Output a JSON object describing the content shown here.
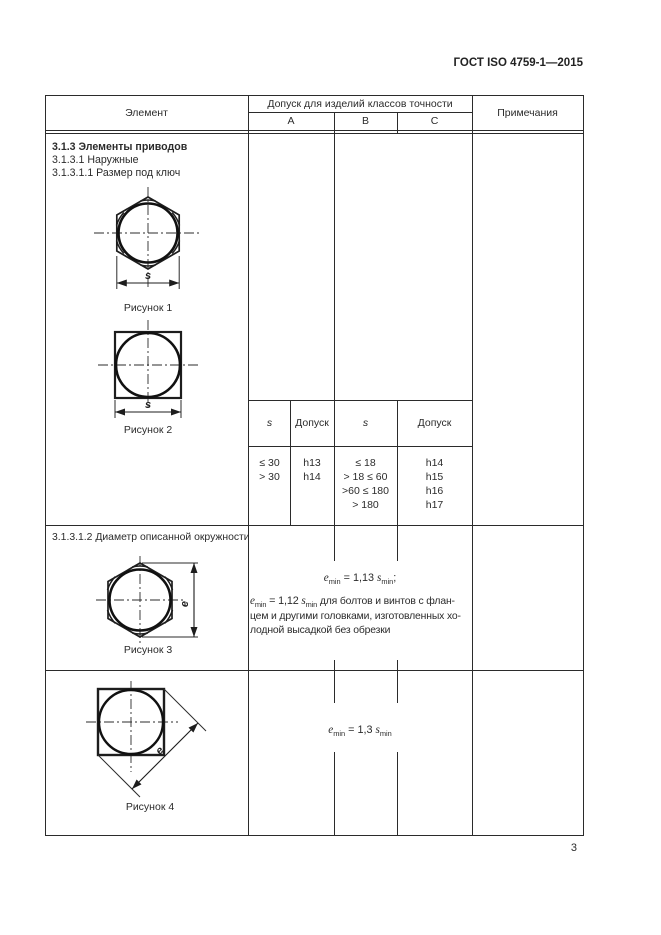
{
  "page": {
    "doc_header": "ГОСТ ISO 4759-1—2015",
    "page_number": "3"
  },
  "table": {
    "header": {
      "element": "Элемент",
      "tolerance_span": "Допуск для изделий классов точности",
      "class_a": "A",
      "class_b": "B",
      "class_c": "C",
      "notes": "Примечания"
    },
    "row1": {
      "heading": "3.1.3  Элементы приводов",
      "sub1": "3.1.3.1  Наружные",
      "sub2": "3.1.3.1.1  Размер под ключ",
      "fig1_caption": "Рисунок 1",
      "fig1_dim": "s",
      "fig2_caption": "Рисунок 2",
      "fig2_dim": "s",
      "subtable": {
        "h_s1": "s",
        "h_tol1": "Допуск",
        "h_s2": "s",
        "h_tol2": "Допуск",
        "a_s": [
          "≤ 30",
          "> 30"
        ],
        "a_tol": [
          "h13",
          "h14"
        ],
        "bc_s": [
          "≤ 18",
          "> 18 ≤ 60",
          ">60 ≤ 180",
          "> 180"
        ],
        "bc_tol": [
          "h14",
          "h15",
          "h16",
          "h17"
        ]
      }
    },
    "row2": {
      "heading": "3.1.3.1.2  Диаметр описанной окружности",
      "fig3_caption": "Рисунок 3",
      "fig3_dim": "e",
      "formula1": {
        "v1": "e",
        "s1": "min",
        "mid": " = 1,13 ",
        "v2": "s",
        "s2": "min",
        "tail": ";"
      },
      "formula2": {
        "v1": "e",
        "s1": "min",
        "mid": " = 1,12 ",
        "v2": "s",
        "s2": "min"
      },
      "note_line1": " для болтов и винтов с флан-",
      "note_line2": "цем и другими головками, изготовленных хо-",
      "note_line3": "лодной высадкой без обрезки"
    },
    "row3": {
      "fig4_caption": "Рисунок 4",
      "fig4_dim": "e",
      "formula": {
        "v1": "e",
        "s1": "min",
        "mid": " = 1,3 ",
        "v2": "s",
        "s2": "min"
      }
    }
  }
}
